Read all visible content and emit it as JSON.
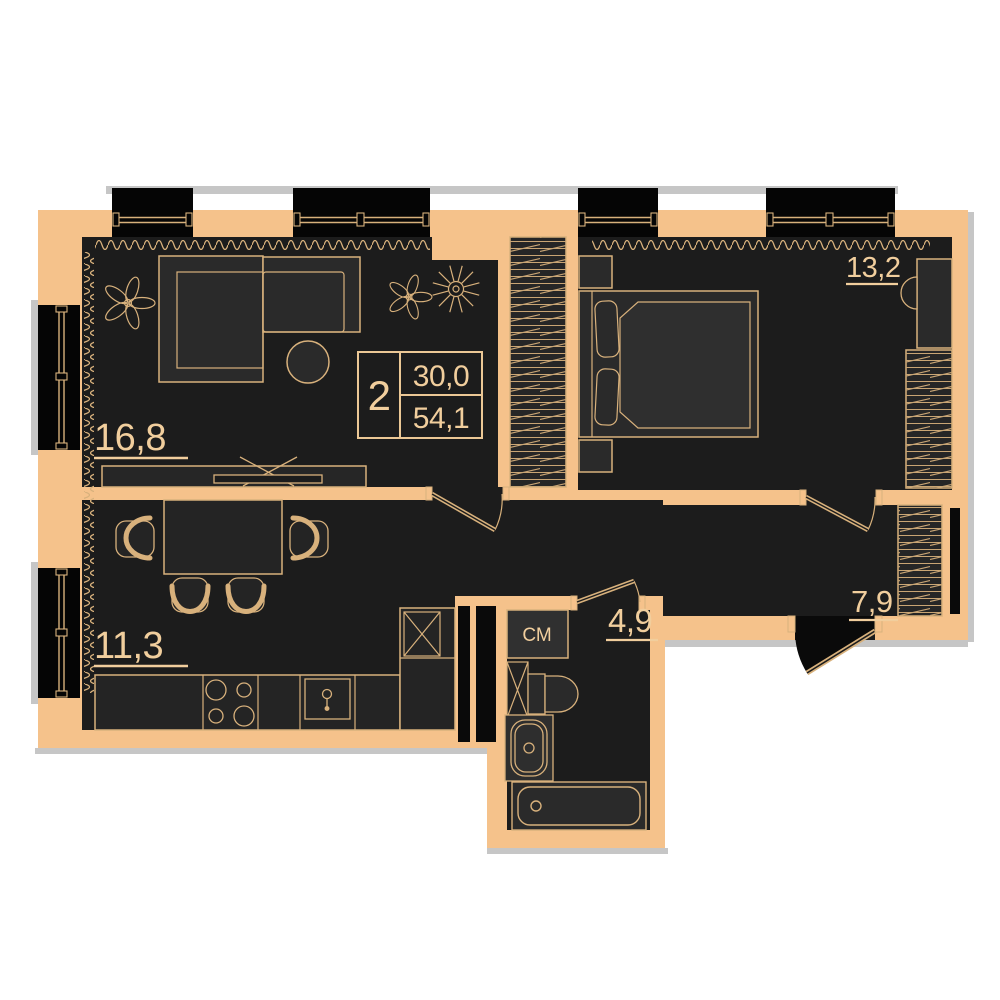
{
  "plan": {
    "kind": "apartment-floor-plan",
    "unit_card": {
      "rooms_count": "2",
      "living_area": "30,0",
      "total_area": "54,1"
    },
    "room_labels": {
      "living_room": "16,8",
      "bedroom": "13,2",
      "kitchen": "11,3",
      "bathroom": "4,9",
      "hall": "7,9"
    },
    "appliances": {
      "washing_machine": "СМ"
    },
    "colors": {
      "wall": "#F5C28B",
      "floor": "#1C1C1C",
      "furniture_fill": "#2A2A2A",
      "outline": "#D8B17C",
      "text": "#F1CE9D",
      "window_black": "#050505",
      "shadow_gray": "#C6C6C6",
      "background": "#FFFFFF"
    }
  }
}
